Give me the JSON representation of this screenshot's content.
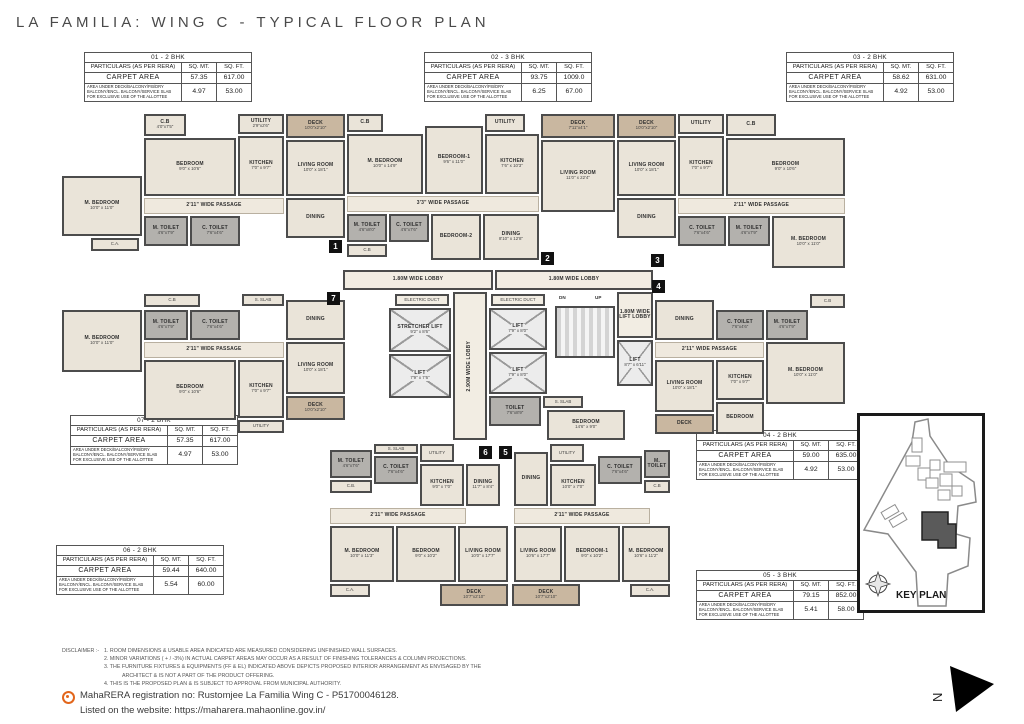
{
  "title": "LA FAMILIA: WING C - TYPICAL FLOOR PLAN",
  "table_headers": [
    "PARTICULARS (AS PER RERA)",
    "SQ. MT.",
    "SQ. FT."
  ],
  "labels": {
    "carpet_area": "CARPET AREA",
    "area_under": "AREA UNDER DECK/BALCONY/P.B/DRY BALCONY/ENCL. BALCONY/SERVICE SLAB FOR EXCLUSIVE USE OF THE ALLOTTEE"
  },
  "tables": [
    {
      "title": "01 - 2 BHK",
      "carpet": [
        "57.35",
        "617.00"
      ],
      "extra": [
        "4.97",
        "53.00"
      ]
    },
    {
      "title": "02 - 3 BHK",
      "carpet": [
        "93.75",
        "1009.0"
      ],
      "extra": [
        "6.25",
        "67.00"
      ]
    },
    {
      "title": "03 - 2 BHK",
      "carpet": [
        "58.62",
        "631.00"
      ],
      "extra": [
        "4.92",
        "53.00"
      ]
    },
    {
      "title": "04 - 2 BHK",
      "carpet": [
        "59.00",
        "635.00"
      ],
      "extra": [
        "4.92",
        "53.00"
      ]
    },
    {
      "title": "05 - 3 BHK",
      "carpet": [
        "79.15",
        "852.00"
      ],
      "extra": [
        "5.41",
        "58.00"
      ]
    },
    {
      "title": "06 - 2 BHK",
      "carpet": [
        "59.44",
        "640.00"
      ],
      "extra": [
        "5.54",
        "60.00"
      ]
    },
    {
      "title": "07 - 2 BHK",
      "carpet": [
        "57.35",
        "617.00"
      ],
      "extra": [
        "4.97",
        "53.00"
      ]
    }
  ],
  "markers": {
    "m1": "1",
    "m2": "2",
    "m3": "3",
    "m4": "4",
    "m5": "5",
    "m6": "6",
    "m7": "7"
  },
  "rooms": {
    "u1_cb": [
      "C.B",
      "4'0\"x7'5\""
    ],
    "u1_bedroom": [
      "BEDROOM",
      "9'0\" x 10'6\""
    ],
    "u1_utility": [
      "UTILITY",
      "2'9\"x2'6\""
    ],
    "u1_kitchen": [
      "KITCHEN",
      "7'0\" x 9'7\""
    ],
    "u1_deck": [
      "DECK",
      "10'0\"x2'10\""
    ],
    "u1_living": [
      "LIVING ROOM",
      "10'0\" x 18'1\""
    ],
    "u1_passage": [
      "2'11\" WIDE PASSAGE"
    ],
    "u1_mbed": [
      "M. BEDROOM",
      "10'0\" x 11'0\""
    ],
    "u1_mtoilet": [
      "M. TOILET",
      "4'6\"x7'9\""
    ],
    "u1_ctoilet": [
      "C. TOILET",
      "7'6\"x4'6\""
    ],
    "u1_dining": [
      "DINING"
    ],
    "u1_ca": [
      "C.A.",
      "8'11\"x2'0\""
    ],
    "u2_cb_a": [
      "C.B"
    ],
    "u2_mbed": [
      "M. BEDROOM",
      "10'0\" x 14'9\""
    ],
    "u2_bed1": [
      "BEDROOM-1",
      "9'6\" x 11'0\""
    ],
    "u2_utility": [
      "UTILITY",
      "4'0\"x2'6\""
    ],
    "u2_kitchen": [
      "KITCHEN",
      "7'6\" x 10'3\""
    ],
    "u2_deck": [
      "DECK",
      "7'11\"x4'1\""
    ],
    "u2_living": [
      "LIVING ROOM",
      "11'0\" x 22'4\""
    ],
    "u2_passage": [
      "3'3\" WIDE PASSAGE"
    ],
    "u2_mtoilet": [
      "M. TOILET",
      "4'6\"x8'0\""
    ],
    "u2_ctoilet": [
      "C. TOILET",
      "4'6\"x7'6\""
    ],
    "u2_cb_b": [
      "C.B"
    ],
    "u2_bed2": [
      "BEDROOM-2"
    ],
    "u2_dining": [
      "DINING",
      "8'10\" x 12'8\""
    ],
    "u3_deck": [
      "DECK",
      "10'0\"x2'10\""
    ],
    "u3_living": [
      "LIVING ROOM",
      "10'0\" x 18'1\""
    ],
    "u3_utility": [
      "UTILITY",
      "2'6\"x2'6\""
    ],
    "u3_kitchen": [
      "KITCHEN",
      "7'0\" x 9'7\""
    ],
    "u3_cb": [
      "C.B",
      "4'0\"x2'5\""
    ],
    "u3_bedroom": [
      "BEDROOM",
      "9'0\" x 10'6\""
    ],
    "u3_passage": [
      "2'11\" WIDE PASSAGE"
    ],
    "u3_dining": [
      "DINING"
    ],
    "u3_ctoilet": [
      "C. TOILET",
      "7'6\"x4'6\""
    ],
    "u3_mtoilet": [
      "M. TOILET",
      "4'6\"x7'9\""
    ],
    "u3_mbed": [
      "M. BEDROOM",
      "10'0\" x 11'0\""
    ],
    "u7_cb": [
      "C.B",
      "8'11\"x2'0\""
    ],
    "u7_mbed": [
      "M. BEDROOM",
      "10'0\" x 11'0\""
    ],
    "u7_mtoilet": [
      "M. TOILET",
      "4'6\"x7'9\""
    ],
    "u7_ctoilet": [
      "C. TOILET",
      "7'6\"x4'6\""
    ],
    "u7_sslab": [
      "S. SLAB"
    ],
    "u7_dining": [
      "DINING"
    ],
    "u7_passage": [
      "2'11\" WIDE PASSAGE"
    ],
    "u7_bedroom": [
      "BEDROOM",
      "9'0\" x 10'6\""
    ],
    "u7_kitchen": [
      "KITCHEN",
      "7'0\" x 9'7\""
    ],
    "u7_living": [
      "LIVING ROOM",
      "10'0\" x 18'1\""
    ],
    "u7_deck": [
      "DECK",
      "10'0\"x2'10\""
    ],
    "u7_utility": [
      "UTILITY",
      "2'9\"x2'6\""
    ],
    "u4_dining": [
      "DINING"
    ],
    "u4_ctoilet": [
      "C. TOILET",
      "7'6\"x4'6\""
    ],
    "u4_mtoilet": [
      "M. TOILET",
      "4'6\"x7'9\""
    ],
    "u4_cb": [
      "C.B"
    ],
    "u4_mbed": [
      "M. BEDROOM",
      "10'0\" x 11'0\""
    ],
    "u4_passage": [
      "2'11\" WIDE PASSAGE"
    ],
    "u4_living": [
      "LIVING ROOM",
      "10'0\" x 18'1\""
    ],
    "u4_deck": [
      "DECK",
      "10'0\"x2'10\""
    ],
    "u4_kitchen": [
      "KITCHEN",
      "7'0\" x 9'7\""
    ],
    "u4_bedroom": [
      "BEDROOM",
      "9'0\" x 10'6\""
    ],
    "u6_mtoilet": [
      "M. TOILET",
      "4'6\"x7'6\""
    ],
    "u6_sslab": [
      "S. SLAB"
    ],
    "u6_ctoilet": [
      "C. TOILET",
      "7'6\"x4'6\""
    ],
    "u6_cb": [
      "C.B.",
      "6'6\"x2'0\""
    ],
    "u6_utility": [
      "UTILITY",
      "2'7\"x5'9\""
    ],
    "u6_kitchen": [
      "KITCHEN",
      "9'0\" x 7'0\""
    ],
    "u6_dining": [
      "DINING",
      "11'7\" x 8'4\""
    ],
    "u6_passage": [
      "2'11\" WIDE PASSAGE"
    ],
    "u6_mbed": [
      "M. BEDROOM",
      "10'0\" x 11'3\""
    ],
    "u6_bedroom": [
      "BEDROOM",
      "9'0\" x 10'2\""
    ],
    "u6_living": [
      "LIVING ROOM",
      "10'0\" x 17'7\""
    ],
    "u6_deck": [
      "DECK",
      "10'7\"x2'10\""
    ],
    "u6_ca": [
      "C.A.",
      "4'9\"x2'0\""
    ],
    "u5_dining": [
      "DINING"
    ],
    "u5_kitchen": [
      "KITCHEN",
      "10'0\" x 7'0\""
    ],
    "u5_utility": [
      "UTILITY",
      "2'7\"x5'9\""
    ],
    "u5_ctoilet": [
      "C. TOILET",
      "7'6\"x4'6\""
    ],
    "u5_mtoilet": [
      "M. TOILET",
      "4'6\"x7'6\""
    ],
    "u5_cb": [
      "C.B"
    ],
    "u5_passage": [
      "2'11\" WIDE PASSAGE"
    ],
    "u5_living": [
      "LIVING ROOM",
      "10'6\" x 17'7\""
    ],
    "u5_bed1": [
      "BEDROOM-1",
      "9'0\" x 10'2\""
    ],
    "u5_mbed": [
      "M. BEDROOM",
      "10'6\" x 11'2\""
    ],
    "u5_deck": [
      "DECK",
      "10'7\"x2'10\""
    ],
    "u5_ca": [
      "C.A.",
      "4'7\"x2'6\""
    ],
    "u5_bedroom": [
      "BEDROOM",
      "14'6\" x 9'0\""
    ],
    "u5_toilet": [
      "TOILET",
      "7'6\"x8'9\""
    ],
    "core_hlobby1": [
      "1.80M WIDE LOBBY"
    ],
    "core_hlobby2": [
      "1.80M WIDE LOBBY"
    ],
    "core_educt1": [
      "ELECTRIC DUCT"
    ],
    "core_educt2": [
      "ELECTRIC DUCT"
    ],
    "core_stretcher": [
      "STRETCHER LIFT",
      "9'2\" x 8'6\""
    ],
    "core_lift1": [
      "LIFT",
      "7'9\" x 7'6\""
    ],
    "core_lift2": [
      "LIFT",
      "7'9\" x 8'0\""
    ],
    "core_lift3": [
      "LIFT",
      "7'9\" x 8'0\""
    ],
    "core_lift4": [
      "LIFT",
      "8'7\" x 6'11\""
    ],
    "core_vlobby": [
      "2.90M WIDE LOBBY"
    ],
    "core_liftlobby": [
      "1.80M WIDE LIFT LOBBY"
    ],
    "core_sslab": [
      "S. SLAB"
    ],
    "core_dn": [
      "DN"
    ],
    "core_up": [
      "UP"
    ]
  },
  "key_plan": {
    "label": "KEY PLAN"
  },
  "north_label": "N",
  "disclaimer": {
    "heading": "DISCLAIMER :-",
    "lines": [
      "1. ROOM DIMENSIONS & USABLE  AREA INDICATED  ARE MEASURED CONSIDERING UNFINISHED WALL SURFACES.",
      "2. MINOR VARIATIONS ( + / -3%) IN ACTUAL CARPET AREAS MAY OCCUR AS A RESULT OF  FINISHING TOLERANCES & COLUMN PROJECTIONS.",
      "3. THE FURNITURE FIXTURES & EQUIPMENTS (FF & EL)  INDICATED ABOVE  DEPICTS PROPOSED INTERIOR ARRANGEMENT AS ENVISAGED BY  THE",
      "ARCHITECT & IS NOT A PART OF THE PRODUCT OFFERING.",
      "4. THIS IS THE PROPOSED PLAN & IS SUBJECT TO APPROVAL FROM MUNICIPAL AUTHORITY."
    ]
  },
  "rera": {
    "line1": "MahaRERA registration no: Rustomjee La Familia Wing C - P51700046128.",
    "line2": "Listed on the website: https://maharera.mahaonline.gov.in/"
  }
}
